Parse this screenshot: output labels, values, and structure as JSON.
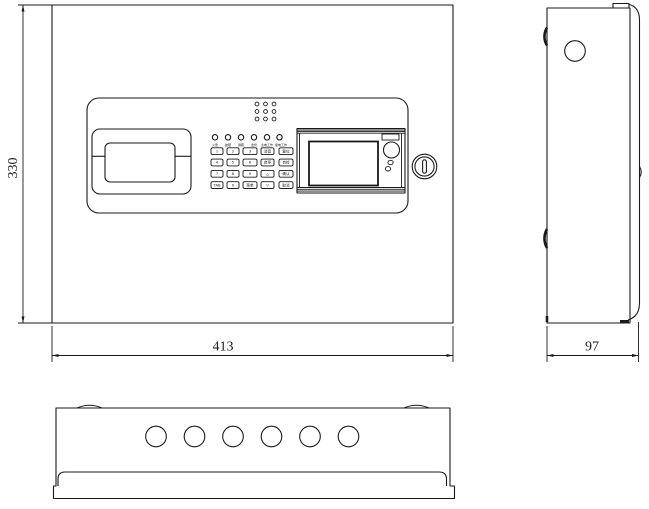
{
  "title": "control-panel-engineering-drawing",
  "colors": {
    "line": "#1a1a1a",
    "background": "#ffffff"
  },
  "front_view": {
    "dim_height": "330",
    "dim_width": "413",
    "led_labels": [
      "火警",
      "故障",
      "屏蔽",
      "监管",
      "主电工作",
      "备电工作"
    ],
    "keypad_keys": [
      "1",
      "2",
      "3",
      "消音",
      "复位",
      "4",
      "5",
      "6",
      "启停",
      "自检",
      "7",
      "8",
      "9",
      "△",
      "确认",
      "TAB",
      "0",
      "菜单",
      "▽",
      "取消"
    ]
  },
  "side_view": {
    "dim_depth": "97"
  }
}
